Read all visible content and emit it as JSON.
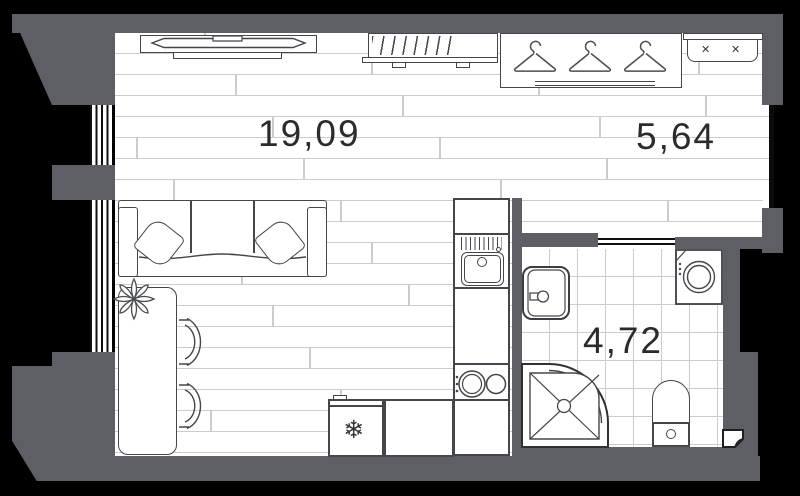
{
  "plan": {
    "type": "floor-plan",
    "rooms": [
      {
        "id": "living-room",
        "area_label": "19,09"
      },
      {
        "id": "hallway",
        "area_label": "5,64"
      },
      {
        "id": "bathroom",
        "area_label": "4,72"
      }
    ],
    "glyphs": {
      "fridge_snowflake": "❄",
      "bench_mark": "✕"
    },
    "colors": {
      "background": "#000000",
      "wall": "#5E5F64",
      "floor_lines": "#C9CCD0",
      "outline": "#43464A",
      "label_text": "#2B2B2E"
    }
  }
}
